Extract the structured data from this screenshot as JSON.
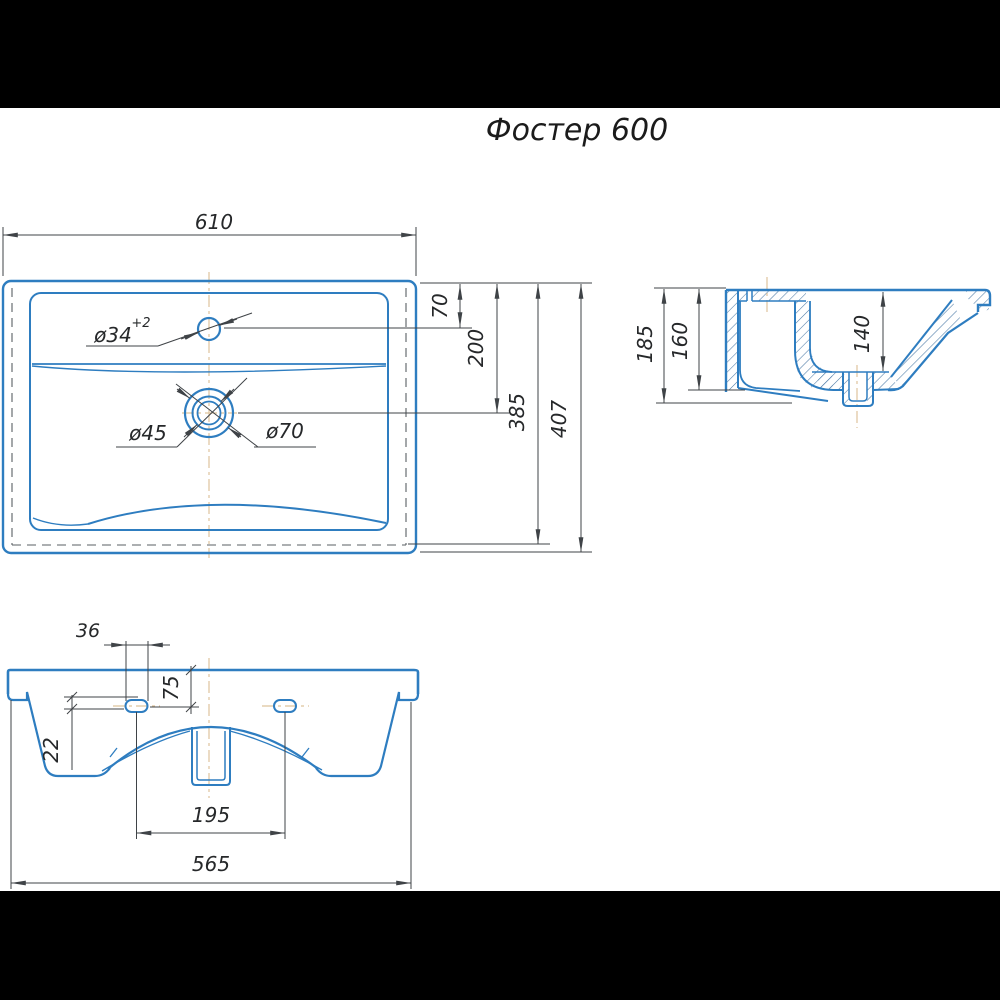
{
  "title": "Фостер 600",
  "top_view": {
    "dim_width": "610",
    "dim_hole_offset": "70",
    "dim_drain_offset": "200",
    "dim_inner_depth": "385",
    "dim_total_depth": "407",
    "label_faucet_hole": "ø34",
    "label_faucet_tolerance": "+2",
    "label_drain_inner": "ø45",
    "label_drain_outer": "ø70"
  },
  "side_view": {
    "dim_total_height": "185",
    "dim_back_height": "160",
    "dim_bowl_depth": "140"
  },
  "front_view": {
    "dim_slot_width": "36",
    "dim_slot_top_offset": "75",
    "dim_slot_height": "22",
    "dim_slot_spacing": "195",
    "dim_base_width": "565"
  },
  "colors": {
    "outline": "#2e7dc0",
    "dimension": "#3f4347",
    "centerline": "#dec39c",
    "hatch": "#4e7ba6",
    "letterbox": "#000000"
  }
}
